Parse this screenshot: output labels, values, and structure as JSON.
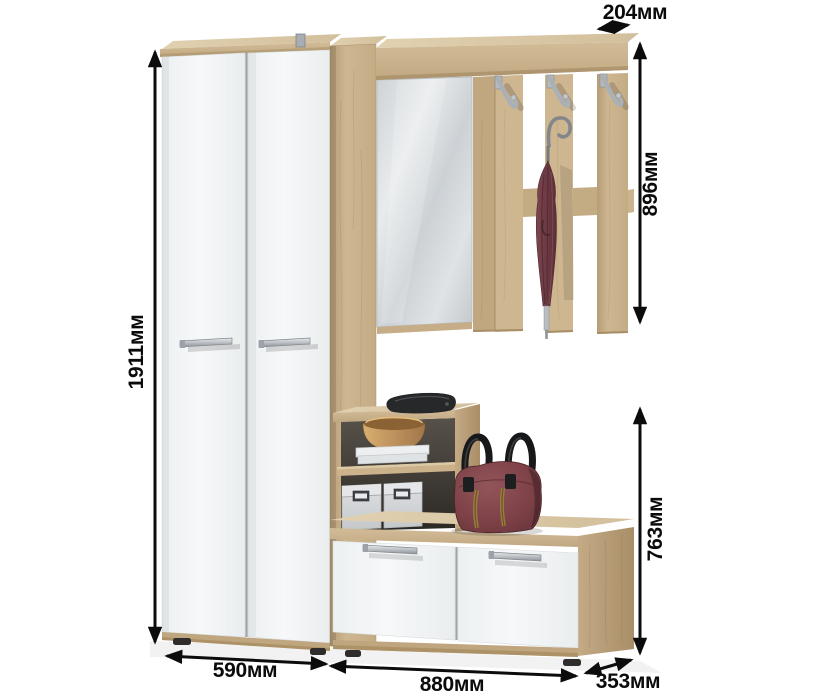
{
  "dimensions": {
    "top_depth": "204мм",
    "rack_height": "896мм",
    "total_height": "1911мм",
    "bench_height": "763мм",
    "wardrobe_width": "590мм",
    "cabinet_width": "880мм",
    "side_depth": "353мм"
  },
  "colors": {
    "background": "#ffffff",
    "oak": "#c9b28c",
    "oak_light": "#dccbaa",
    "oak_dark": "#ab916b",
    "door_white": "#f2f4f5",
    "mirror": "#d7dcdf",
    "metal": "#b7bcc1",
    "umbrella_burgundy": "#6e3b44",
    "bag_burgundy": "#7b3f45",
    "storage_box_gray": "#d3d5d7",
    "dimension_black": "#0b0b0b"
  }
}
